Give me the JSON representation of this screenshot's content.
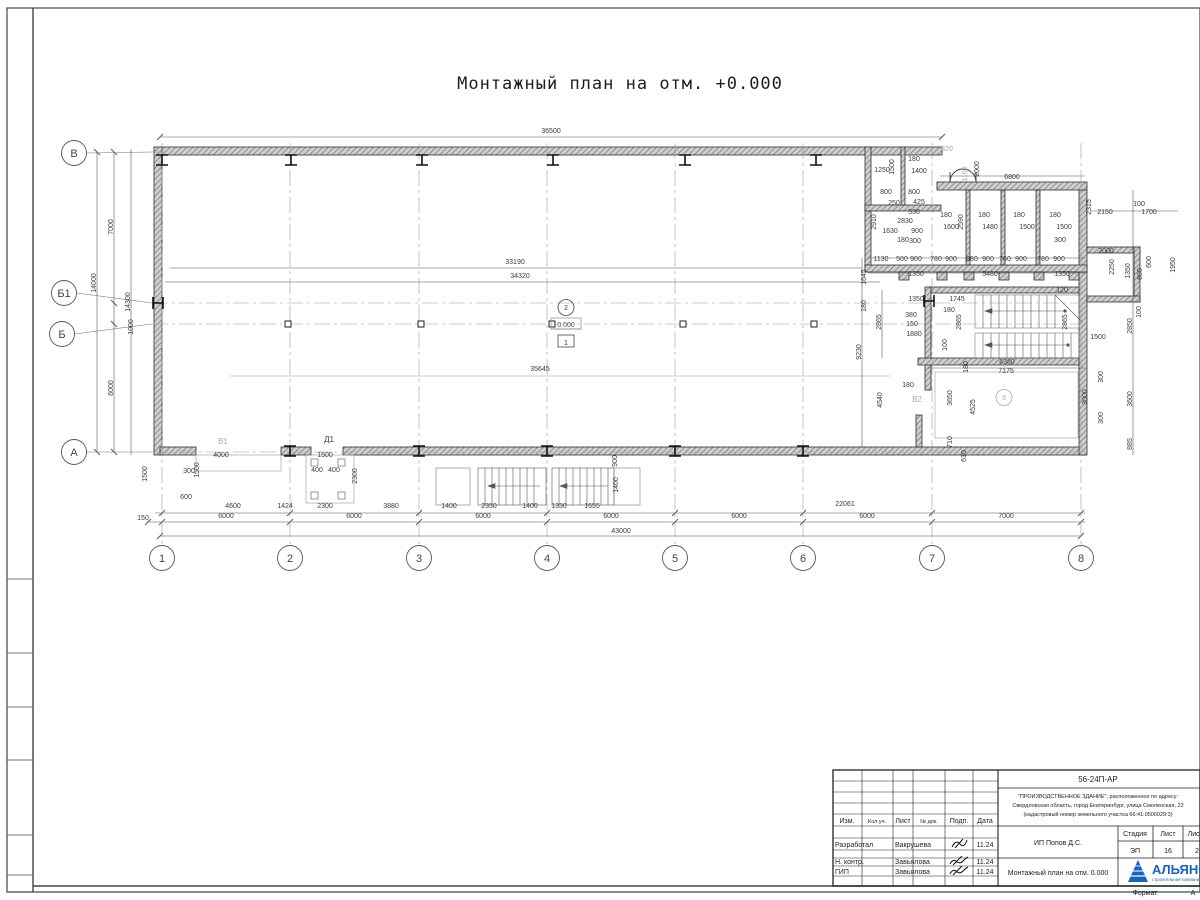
{
  "sheet": {
    "title": "Монтажный план на отм. +0.000",
    "watermark": "АЛЬЯНС   СТРОИТЕЛЬНАЯ КОМПАНИЯ",
    "format_label": "Формат",
    "format_value": "А"
  },
  "axes": {
    "bottom": [
      {
        "label": "1",
        "x": 162
      },
      {
        "label": "2",
        "x": 290
      },
      {
        "label": "3",
        "x": 419
      },
      {
        "label": "4",
        "x": 547
      },
      {
        "label": "5",
        "x": 675
      },
      {
        "label": "6",
        "x": 803
      },
      {
        "label": "7",
        "x": 932
      },
      {
        "label": "8",
        "x": 1081
      }
    ],
    "left": [
      {
        "label": "В",
        "cx": 74,
        "cy": 153,
        "y": 152,
        "x2": 165
      },
      {
        "label": "Б1",
        "cx": 64,
        "cy": 293,
        "y": 303,
        "x2": 1085
      },
      {
        "label": "Б",
        "cx": 62,
        "cy": 334,
        "y": 324,
        "x2": 1085
      },
      {
        "label": "А",
        "cx": 74,
        "cy": 452,
        "y": 452,
        "x2": 1085
      }
    ]
  },
  "columns": {
    "ibeam_top": [
      162,
      291,
      422,
      553,
      685,
      816
    ],
    "ibeam_bottom": [
      290,
      419,
      547,
      675,
      803
    ],
    "ibeam_side": [
      [
        158,
        303
      ],
      [
        929,
        301
      ]
    ],
    "squares": [
      [
        288,
        324
      ],
      [
        421,
        324
      ],
      [
        552,
        324
      ],
      [
        683,
        324
      ],
      [
        814,
        324
      ]
    ]
  },
  "dims": [
    {
      "t": "36500",
      "x": 551,
      "y": 133
    },
    {
      "t": "33190",
      "x": 515,
      "y": 264
    },
    {
      "t": "34320",
      "x": 520,
      "y": 278
    },
    {
      "t": "35645",
      "x": 540,
      "y": 371
    },
    {
      "t": "43000",
      "x": 621,
      "y": 533
    },
    {
      "t": "22061",
      "x": 845,
      "y": 506
    },
    {
      "t": "150",
      "x": 143,
      "y": 520
    },
    {
      "t": "6000",
      "x": 226,
      "y": 518
    },
    {
      "t": "6000",
      "x": 354,
      "y": 518
    },
    {
      "t": "6000",
      "x": 483,
      "y": 518
    },
    {
      "t": "6000",
      "x": 611,
      "y": 518
    },
    {
      "t": "6000",
      "x": 739,
      "y": 518
    },
    {
      "t": "6000",
      "x": 867,
      "y": 518
    },
    {
      "t": "7000",
      "x": 1006,
      "y": 518
    },
    {
      "t": "600",
      "x": 186,
      "y": 499
    },
    {
      "t": "4600",
      "x": 233,
      "y": 508
    },
    {
      "t": "1424",
      "x": 285,
      "y": 508
    },
    {
      "t": "2300",
      "x": 325,
      "y": 508
    },
    {
      "t": "3880",
      "x": 391,
      "y": 508
    },
    {
      "t": "1400",
      "x": 449,
      "y": 508
    },
    {
      "t": "2350",
      "x": 489,
      "y": 508
    },
    {
      "t": "1400",
      "x": 530,
      "y": 508
    },
    {
      "t": "1330",
      "x": 559,
      "y": 508
    },
    {
      "t": "1655",
      "x": 592,
      "y": 508
    },
    {
      "t": "7000",
      "x": 113,
      "y": 227,
      "r": 1
    },
    {
      "t": "14000",
      "x": 96,
      "y": 283,
      "r": 1
    },
    {
      "t": "14300",
      "x": 130,
      "y": 302,
      "r": 1
    },
    {
      "t": "1000",
      "x": 133,
      "y": 327,
      "r": 1
    },
    {
      "t": "6000",
      "x": 113,
      "y": 388,
      "r": 1
    },
    {
      "t": "1500",
      "x": 147,
      "y": 474,
      "r": 1
    },
    {
      "t": "300",
      "x": 189,
      "y": 473
    },
    {
      "t": "1500",
      "x": 199,
      "y": 470,
      "r": 1
    },
    {
      "t": "4000",
      "x": 221,
      "y": 457
    },
    {
      "t": "1500",
      "x": 325,
      "y": 457
    },
    {
      "t": "400",
      "x": 317,
      "y": 472
    },
    {
      "t": "400",
      "x": 334,
      "y": 472
    },
    {
      "t": "2300",
      "x": 357,
      "y": 476,
      "r": 1
    },
    {
      "t": "900",
      "x": 617,
      "y": 461,
      "r": 1
    },
    {
      "t": "1400",
      "x": 618,
      "y": 485,
      "r": 1
    },
    {
      "t": "1250",
      "x": 882,
      "y": 172
    },
    {
      "t": "1500",
      "x": 894,
      "y": 167,
      "r": 1
    },
    {
      "t": "180",
      "x": 914,
      "y": 161
    },
    {
      "t": "1400",
      "x": 919,
      "y": 173
    },
    {
      "t": "800",
      "x": 886,
      "y": 194
    },
    {
      "t": "800",
      "x": 914,
      "y": 194
    },
    {
      "t": "250",
      "x": 894,
      "y": 205
    },
    {
      "t": "425",
      "x": 919,
      "y": 204
    },
    {
      "t": "530",
      "x": 914,
      "y": 214
    },
    {
      "t": "2830",
      "x": 905,
      "y": 223
    },
    {
      "t": "2910",
      "x": 876,
      "y": 222,
      "r": 1
    },
    {
      "t": "1630",
      "x": 890,
      "y": 233
    },
    {
      "t": "900",
      "x": 917,
      "y": 233
    },
    {
      "t": "180",
      "x": 903,
      "y": 242
    },
    {
      "t": "300",
      "x": 915,
      "y": 243
    },
    {
      "t": "820",
      "x": 947,
      "y": 151,
      "g": 1
    },
    {
      "t": "2000",
      "x": 979,
      "y": 169,
      "r": 1
    },
    {
      "t": "1100",
      "x": 967,
      "y": 174,
      "r": 1,
      "g": 1
    },
    {
      "t": "6800",
      "x": 1012,
      "y": 179
    },
    {
      "t": "180",
      "x": 946,
      "y": 217
    },
    {
      "t": "1600",
      "x": 951,
      "y": 229
    },
    {
      "t": "2590",
      "x": 963,
      "y": 222,
      "r": 1
    },
    {
      "t": "180",
      "x": 984,
      "y": 217
    },
    {
      "t": "1480",
      "x": 990,
      "y": 229
    },
    {
      "t": "180",
      "x": 1019,
      "y": 217
    },
    {
      "t": "1500",
      "x": 1027,
      "y": 229
    },
    {
      "t": "180",
      "x": 1055,
      "y": 217
    },
    {
      "t": "1500",
      "x": 1064,
      "y": 229
    },
    {
      "t": "300",
      "x": 1060,
      "y": 242
    },
    {
      "t": "2315",
      "x": 1091,
      "y": 207,
      "r": 1
    },
    {
      "t": "2150",
      "x": 1105,
      "y": 214
    },
    {
      "t": "100",
      "x": 1139,
      "y": 206
    },
    {
      "t": "1700",
      "x": 1149,
      "y": 214
    },
    {
      "t": "2000",
      "x": 1106,
      "y": 253
    },
    {
      "t": "2250",
      "x": 1114,
      "y": 267,
      "r": 1
    },
    {
      "t": "1350",
      "x": 1130,
      "y": 271,
      "r": 1
    },
    {
      "t": "600",
      "x": 1142,
      "y": 274,
      "r": 1
    },
    {
      "t": "600",
      "x": 1151,
      "y": 262,
      "r": 1
    },
    {
      "t": "1950",
      "x": 1175,
      "y": 265,
      "r": 1
    },
    {
      "t": "100",
      "x": 1141,
      "y": 312,
      "r": 1
    },
    {
      "t": "2850",
      "x": 1132,
      "y": 326,
      "r": 1
    },
    {
      "t": "1500",
      "x": 1098,
      "y": 339
    },
    {
      "t": "120",
      "x": 1062,
      "y": 292
    },
    {
      "t": "1130",
      "x": 881,
      "y": 261
    },
    {
      "t": "500",
      "x": 902,
      "y": 261
    },
    {
      "t": "900",
      "x": 916,
      "y": 261
    },
    {
      "t": "780",
      "x": 936,
      "y": 261
    },
    {
      "t": "900",
      "x": 951,
      "y": 261
    },
    {
      "t": "880",
      "x": 972,
      "y": 261
    },
    {
      "t": "900",
      "x": 988,
      "y": 261
    },
    {
      "t": "760",
      "x": 1005,
      "y": 261
    },
    {
      "t": "900",
      "x": 1021,
      "y": 261
    },
    {
      "t": "780",
      "x": 1043,
      "y": 261
    },
    {
      "t": "900",
      "x": 1059,
      "y": 261
    },
    {
      "t": "1645",
      "x": 866,
      "y": 277,
      "r": 1
    },
    {
      "t": "1350",
      "x": 916,
      "y": 276
    },
    {
      "t": "5480",
      "x": 990,
      "y": 276
    },
    {
      "t": "1350",
      "x": 1062,
      "y": 276
    },
    {
      "t": "180",
      "x": 866,
      "y": 306,
      "r": 1
    },
    {
      "t": "9230",
      "x": 861,
      "y": 352,
      "r": 1
    },
    {
      "t": "1350",
      "x": 916,
      "y": 301
    },
    {
      "t": "1745",
      "x": 957,
      "y": 301
    },
    {
      "t": "180",
      "x": 949,
      "y": 312
    },
    {
      "t": "380",
      "x": 911,
      "y": 317
    },
    {
      "t": "150",
      "x": 912,
      "y": 326
    },
    {
      "t": "1880",
      "x": 914,
      "y": 336
    },
    {
      "t": "2865",
      "x": 881,
      "y": 322,
      "r": 1
    },
    {
      "t": "2865",
      "x": 961,
      "y": 322,
      "r": 1
    },
    {
      "t": "2865",
      "x": 1067,
      "y": 322,
      "r": 1
    },
    {
      "t": "100",
      "x": 947,
      "y": 345,
      "r": 1
    },
    {
      "t": "6380",
      "x": 1007,
      "y": 364
    },
    {
      "t": "7175",
      "x": 1006,
      "y": 373
    },
    {
      "t": "180",
      "x": 968,
      "y": 367,
      "r": 1
    },
    {
      "t": "180",
      "x": 908,
      "y": 387
    },
    {
      "t": "4540",
      "x": 882,
      "y": 400,
      "r": 1
    },
    {
      "t": "3650",
      "x": 952,
      "y": 398,
      "r": 1
    },
    {
      "t": "4525",
      "x": 975,
      "y": 407,
      "r": 1
    },
    {
      "t": "3000",
      "x": 1087,
      "y": 397,
      "r": 1
    },
    {
      "t": "3600",
      "x": 1132,
      "y": 399,
      "r": 1
    },
    {
      "t": "300",
      "x": 1103,
      "y": 377,
      "r": 1
    },
    {
      "t": "300",
      "x": 1103,
      "y": 418,
      "r": 1
    },
    {
      "t": "710",
      "x": 952,
      "y": 442,
      "r": 1
    },
    {
      "t": "610",
      "x": 966,
      "y": 456,
      "r": 1
    },
    {
      "t": "885",
      "x": 1132,
      "y": 444,
      "r": 1
    }
  ],
  "labels": [
    {
      "kind": "plain",
      "t": "В1",
      "x": 223,
      "y": 444,
      "g": 1
    },
    {
      "kind": "plain",
      "t": "Д1",
      "x": 329,
      "y": 442
    },
    {
      "kind": "plain",
      "t": "В2",
      "x": 917,
      "y": 402,
      "g": 1
    },
    {
      "kind": "circle",
      "t": "2",
      "x": 566,
      "y": 310
    },
    {
      "kind": "level",
      "t": "0.000",
      "x": 566,
      "y": 327
    },
    {
      "kind": "box",
      "t": "1",
      "x": 566,
      "y": 345
    },
    {
      "kind": "circle",
      "t": "3",
      "x": 1004,
      "y": 400,
      "g": 1
    }
  ],
  "titleblock": {
    "doc_number": "56-24П-АР",
    "project_line1": "\"ПРОИЗВОДСТВЕННОЕ ЗДАНИЕ\", расположенное по адресу:",
    "project_line2": "Свердловская область, город Екатеринбург, улица Смоленская, 22",
    "project_line3": "(кадастровый номер земельного участка 66:41:0506029:3)",
    "client": "ИП Попов Д.С.",
    "sheet_title": "Монтажный план на отм. 0.000",
    "stage_label": "Стадия",
    "sheet_label": "Лист",
    "sheets_label": "Листов",
    "stage": "ЭП",
    "sheet_no": "16",
    "sheets_total": "2",
    "col_headers": [
      "Изм.",
      "Кол.уч.",
      "Лист",
      "№ док.",
      "Подп.",
      "Дата"
    ],
    "rows": [
      {
        "role": "Разработал",
        "name": "Вакрушева",
        "date": "11.24"
      },
      {
        "role": "Н. контр.",
        "name": "Завьялова",
        "date": "11.24"
      },
      {
        "role": "ГИП",
        "name": "Завьялова",
        "date": "11.24"
      }
    ],
    "logo_name": "АЛЬЯНС",
    "logo_sub": "строительная компания"
  }
}
